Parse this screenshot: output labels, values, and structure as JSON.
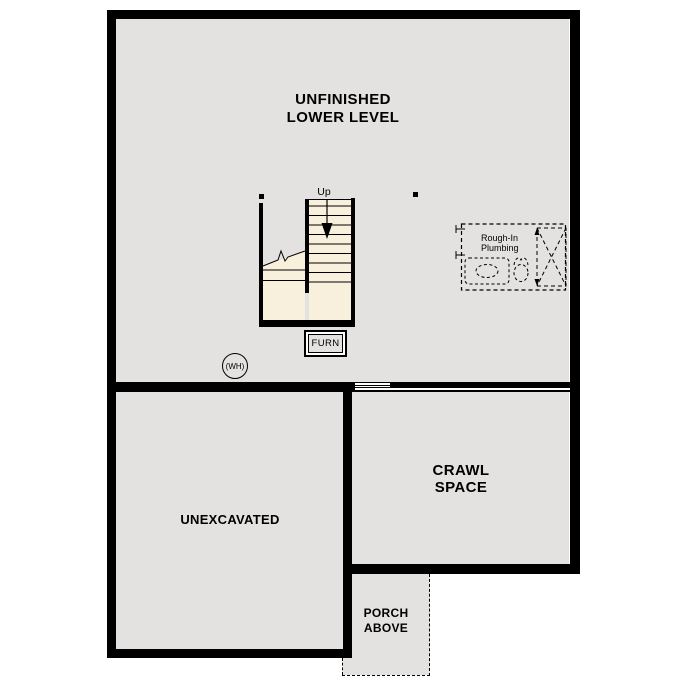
{
  "plan_title": {
    "line1": "UNFINISHED",
    "line2": "LOWER LEVEL"
  },
  "rooms": {
    "unexcavated_label": "UNEXCAVATED",
    "crawl_line1": "CRAWL",
    "crawl_line2": "SPACE",
    "porch_line1": "PORCH",
    "porch_line2": "ABOVE"
  },
  "stairs": {
    "direction_label": "Up"
  },
  "equipment": {
    "furnace_label": "FURN",
    "water_heater_label": "(WH)"
  },
  "plumbing": {
    "line1": "Rough-In",
    "line2": "Plumbing"
  },
  "colors": {
    "wall": "#000000",
    "floor": "#e4e2e0",
    "stair_floor": "#f9efdd",
    "page_bg": "#ffffff",
    "line": "#000000"
  }
}
